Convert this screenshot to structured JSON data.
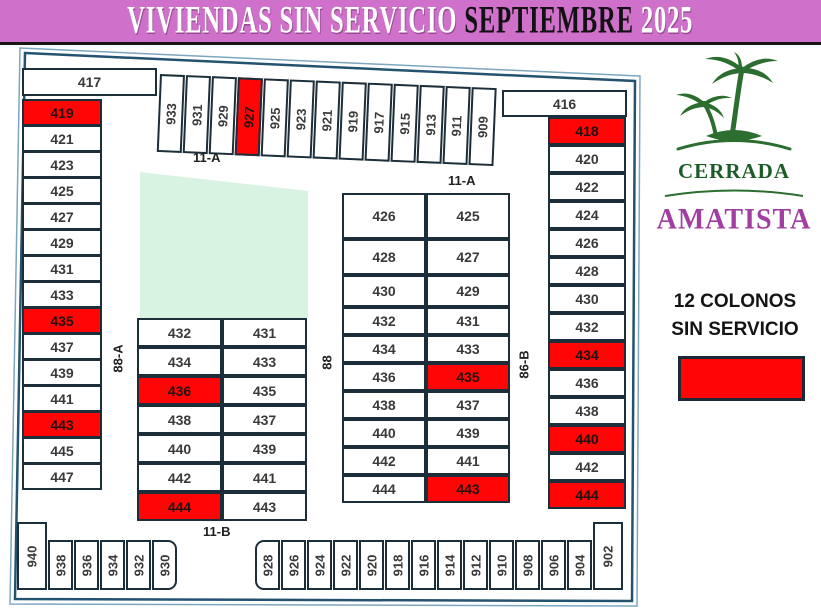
{
  "title": {
    "part1": "VIVIENDAS SIN SERVICIO",
    "part2": "SEPTIEMBRE",
    "part3": "2025"
  },
  "logo": {
    "line1": "CERRADA",
    "line2": "AMATISTA"
  },
  "legend": {
    "line1": "12 COLONOS",
    "line2": "SIN SERVICIO",
    "swatch_color": "#ff0505"
  },
  "streets": {
    "top_left": "11-A",
    "block_right_top": "11-A",
    "bottom": "11-B",
    "left_vertical": "88-A",
    "center_vertical": "88",
    "right_vertical": "86-B"
  },
  "colors": {
    "highlight_red": "#ff0505",
    "title_bg": "#cf70ca",
    "cell_border": "#1c2e3a",
    "outer_border": "#24536f",
    "green_area": "#d9f3e2",
    "logo_green": "#1d5c28",
    "logo_purple": "#a23da2"
  },
  "lots": {
    "left_header": "417",
    "left_column": [
      {
        "n": "419",
        "red": true
      },
      {
        "n": "421"
      },
      {
        "n": "423"
      },
      {
        "n": "425"
      },
      {
        "n": "427"
      },
      {
        "n": "429"
      },
      {
        "n": "431"
      },
      {
        "n": "433"
      },
      {
        "n": "435",
        "red": true
      },
      {
        "n": "437"
      },
      {
        "n": "439"
      },
      {
        "n": "441"
      },
      {
        "n": "443",
        "red": true
      },
      {
        "n": "445"
      },
      {
        "n": "447"
      }
    ],
    "top_row": [
      {
        "n": "933"
      },
      {
        "n": "931"
      },
      {
        "n": "929"
      },
      {
        "n": "927",
        "red": true
      },
      {
        "n": "925"
      },
      {
        "n": "923"
      },
      {
        "n": "921"
      },
      {
        "n": "919"
      },
      {
        "n": "917"
      },
      {
        "n": "915"
      },
      {
        "n": "913"
      },
      {
        "n": "911"
      },
      {
        "n": "909"
      }
    ],
    "right_header": "416",
    "right_column": [
      {
        "n": "418",
        "red": true
      },
      {
        "n": "420"
      },
      {
        "n": "422"
      },
      {
        "n": "424"
      },
      {
        "n": "426"
      },
      {
        "n": "428"
      },
      {
        "n": "430"
      },
      {
        "n": "432"
      },
      {
        "n": "434",
        "red": true
      },
      {
        "n": "436"
      },
      {
        "n": "438"
      },
      {
        "n": "440",
        "red": true
      },
      {
        "n": "442"
      },
      {
        "n": "444",
        "red": true
      }
    ],
    "block_left_rows": [
      [
        {
          "n": "432"
        },
        {
          "n": "431"
        }
      ],
      [
        {
          "n": "434"
        },
        {
          "n": "433"
        }
      ],
      [
        {
          "n": "436",
          "red": true
        },
        {
          "n": "435"
        }
      ],
      [
        {
          "n": "438"
        },
        {
          "n": "437"
        }
      ],
      [
        {
          "n": "440"
        },
        {
          "n": "439"
        }
      ],
      [
        {
          "n": "442"
        },
        {
          "n": "441"
        }
      ],
      [
        {
          "n": "444",
          "red": true
        },
        {
          "n": "443"
        }
      ]
    ],
    "block_right_rows": [
      [
        {
          "n": "426"
        },
        {
          "n": "425"
        }
      ],
      [
        {
          "n": "428"
        },
        {
          "n": "427"
        }
      ],
      [
        {
          "n": "430"
        },
        {
          "n": "429"
        }
      ],
      [
        {
          "n": "432"
        },
        {
          "n": "431"
        }
      ],
      [
        {
          "n": "434"
        },
        {
          "n": "433"
        }
      ],
      [
        {
          "n": "436"
        },
        {
          "n": "435",
          "red": true
        }
      ],
      [
        {
          "n": "438"
        },
        {
          "n": "437"
        }
      ],
      [
        {
          "n": "440"
        },
        {
          "n": "439"
        }
      ],
      [
        {
          "n": "442"
        },
        {
          "n": "441"
        }
      ],
      [
        {
          "n": "444"
        },
        {
          "n": "443",
          "red": true
        }
      ]
    ],
    "bottom_left": [
      {
        "n": "940",
        "tall": true
      },
      {
        "n": "938"
      },
      {
        "n": "936"
      },
      {
        "n": "934"
      },
      {
        "n": "932"
      },
      {
        "n": "930"
      }
    ],
    "bottom_right": [
      {
        "n": "928"
      },
      {
        "n": "926"
      },
      {
        "n": "924"
      },
      {
        "n": "922"
      },
      {
        "n": "920"
      },
      {
        "n": "918"
      },
      {
        "n": "916"
      },
      {
        "n": "914"
      },
      {
        "n": "912"
      },
      {
        "n": "910"
      },
      {
        "n": "908"
      },
      {
        "n": "906"
      },
      {
        "n": "904"
      },
      {
        "n": "902",
        "tall": true
      }
    ]
  }
}
